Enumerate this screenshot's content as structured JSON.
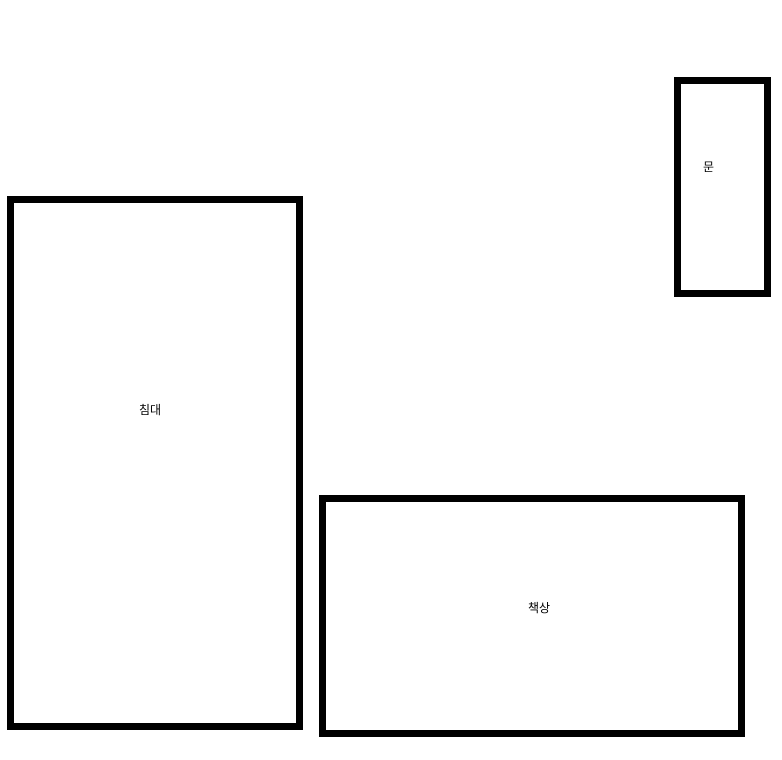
{
  "diagram": {
    "type": "room-floor-plan",
    "background_color": "#ffffff",
    "outline_color": "#000000",
    "outline_thickness_px": 7,
    "shapes": [
      {
        "id": "bed",
        "label": "침대"
      },
      {
        "id": "desk",
        "label": "책상"
      },
      {
        "id": "door",
        "label": "문"
      }
    ]
  }
}
